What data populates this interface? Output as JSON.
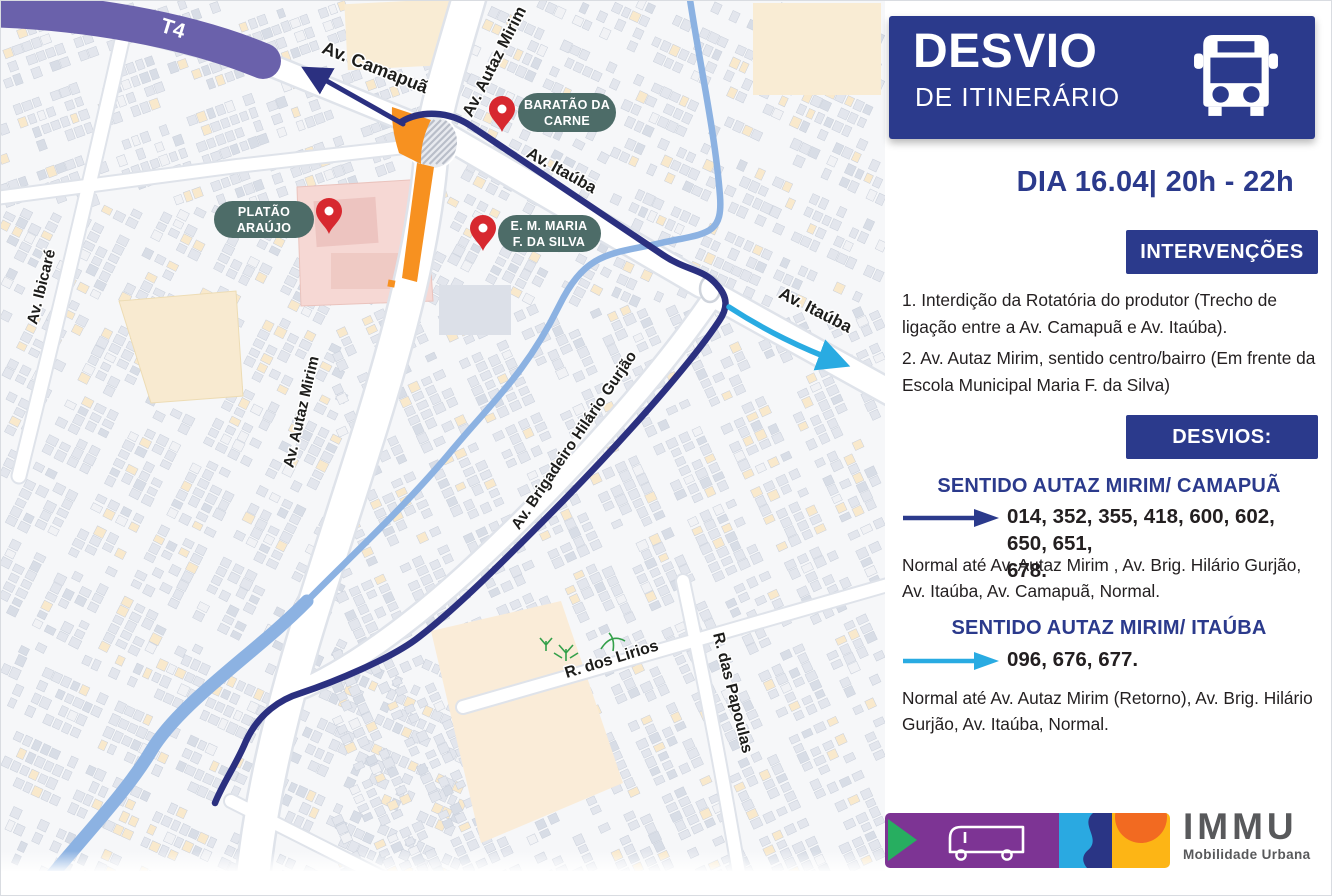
{
  "panel": {
    "header": {
      "title": "DESVIO",
      "subtitle": "DE ITINERÁRIO"
    },
    "date_line": "DIA 16.04| 20h - 22h",
    "interventions": {
      "band_label": "INTERVENÇÕES",
      "items": [
        "1. Interdição da Rotatória do produtor (Trecho de ligação entre a Av. Camapuã e Av. Itaúba).",
        "2. Av. Autaz Mirim, sentido centro/bairro (Em frente da Escola Municipal Maria F. da Silva)"
      ]
    },
    "detours": {
      "band_label": "DESVIOS:",
      "sections": [
        {
          "heading": "SENTIDO AUTAZ MIRIM/ CAMAPUÃ",
          "routes_line1": "014, 352, 355, 418, 600, 602, 650, 651,",
          "routes_line2": "678.",
          "description": "Normal até Av. Autaz Mirim , Av. Brig. Hilário Gurjão, Av. Itaúba, Av. Camapuã, Normal.",
          "arrow_color": "#2b3a8c"
        },
        {
          "heading": "SENTIDO AUTAZ MIRIM/ ITAÚBA",
          "routes_line1": "096, 676, 677.",
          "routes_line2": "",
          "description": "Normal até Av. Autaz Mirim (Retorno), Av.  Brig. Hilário Gurjão, Av. Itaúba, Normal.",
          "arrow_color": "#29abe2"
        }
      ]
    },
    "footer": {
      "logo_title": "IMMU",
      "logo_subtitle": "Mobilidade Urbana"
    }
  },
  "map": {
    "road_labels": {
      "t4": "T4",
      "camapua": "Av. Camapuã",
      "autaz_mirim_top": "Av. Autaz Mirim",
      "itauba_upper": "Av. Itaúba",
      "ibicare": "Av. Ibicaré",
      "autaz_mirim_left": "Av. Autaz Mirim",
      "brigadeiro": "Av. Brigadeiro Hilário Gurjão",
      "itauba_right": "Av. Itaúba",
      "lirios": "R. dos Lirios",
      "papoulas": "R. das Papoulas"
    },
    "poi_badges": {
      "baratao": {
        "line1": "BARATÃO DA",
        "line2": "CARNE"
      },
      "platao": {
        "line1": "PLATÃO",
        "line2": "ARAÚJO"
      },
      "em_maria": {
        "line1": "E. M. MARIA",
        "line2": "F. DA SILVA"
      }
    }
  },
  "colors": {
    "panel_navy": "#2b3a8c",
    "route_navy": "#2b3080",
    "detour_cyan": "#29abe2",
    "closure_orange": "#f79120",
    "pin_red": "#d7282f",
    "badge_green": "#4d6c68",
    "t4_purple": "#6a61ab",
    "footer_purple": "#7d3494",
    "footer_green": "#27ae60",
    "footer_yellow": "#fdb515",
    "footer_orange": "#f26a21",
    "logo_gray": "#58595b"
  }
}
